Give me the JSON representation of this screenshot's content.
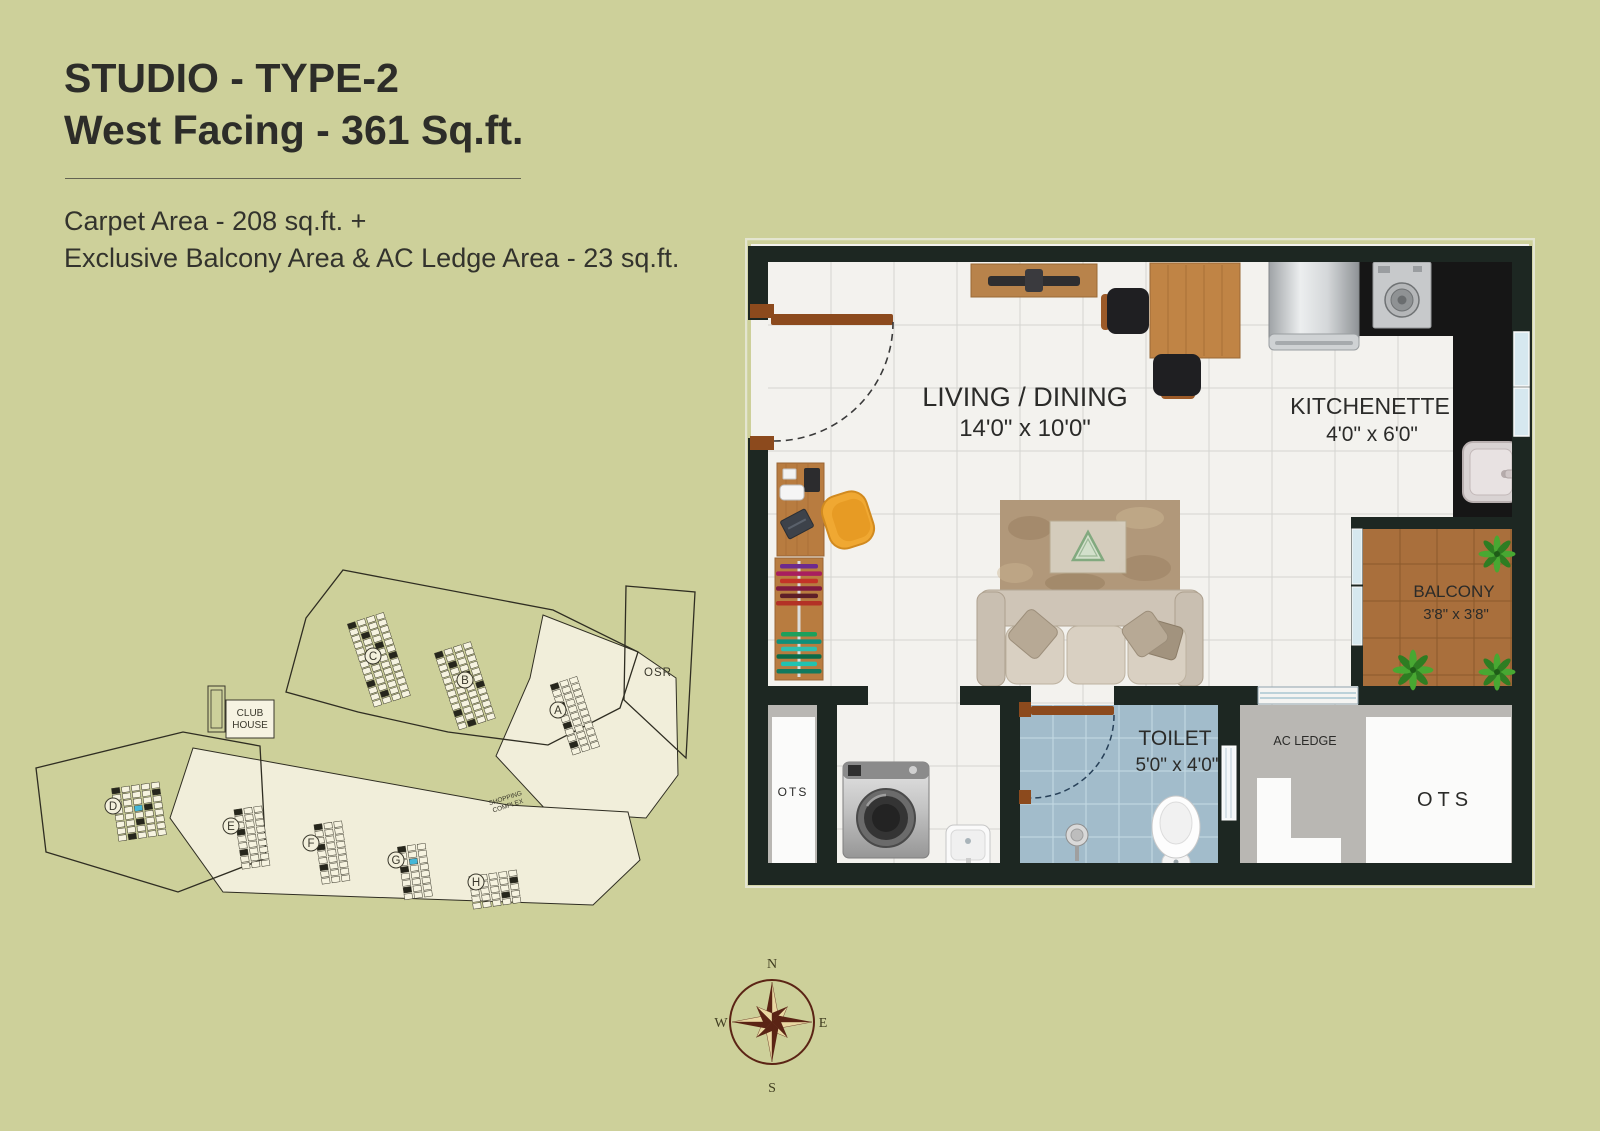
{
  "header": {
    "title_line1": "STUDIO - TYPE-2",
    "title_line2": "West Facing - 361 Sq.ft.",
    "area_line1": "Carpet Area - 208 sq.ft. +",
    "area_line2": "Exclusive Balcony Area & AC Ledge Area - 23 sq.ft."
  },
  "floor_plan": {
    "living": {
      "label": "LIVING / DINING",
      "dims": "14'0\" x 10'0\""
    },
    "kitchenette": {
      "label": "KITCHENETTE",
      "dims": "4'0\" x 6'0\""
    },
    "balcony": {
      "label": "BALCONY",
      "dims": "3'8\" x 3'8\""
    },
    "toilet": {
      "label": "TOILET",
      "dims": "5'0\" x 4'0\""
    },
    "ac_ledge": {
      "label": "AC LEDGE"
    },
    "ots_left": {
      "label": "OTS"
    },
    "ots_right": {
      "label": "OTS"
    }
  },
  "site_plan": {
    "blocks": [
      "C",
      "B",
      "A",
      "D",
      "E",
      "F",
      "G",
      "H"
    ],
    "club_house_line1": "CLUB",
    "club_house_line2": "HOUSE",
    "shopping_line1": "SHOPPING",
    "shopping_line2": "COMPLEX",
    "osr_label": "OSR"
  },
  "compass": {
    "north": "N",
    "east": "E",
    "south": "S",
    "west": "W"
  },
  "colors": {
    "background": "#cdd09a",
    "wall": "#1d2722",
    "wood": "#b87c40",
    "toilet_floor": "#a2bccb",
    "balcony_floor": "#a96f3c",
    "gray_area": "#b9b7b3",
    "highlight_unit": "#45b8d8",
    "compass_dark": "#5b2415",
    "compass_light": "#e9d8a2"
  }
}
